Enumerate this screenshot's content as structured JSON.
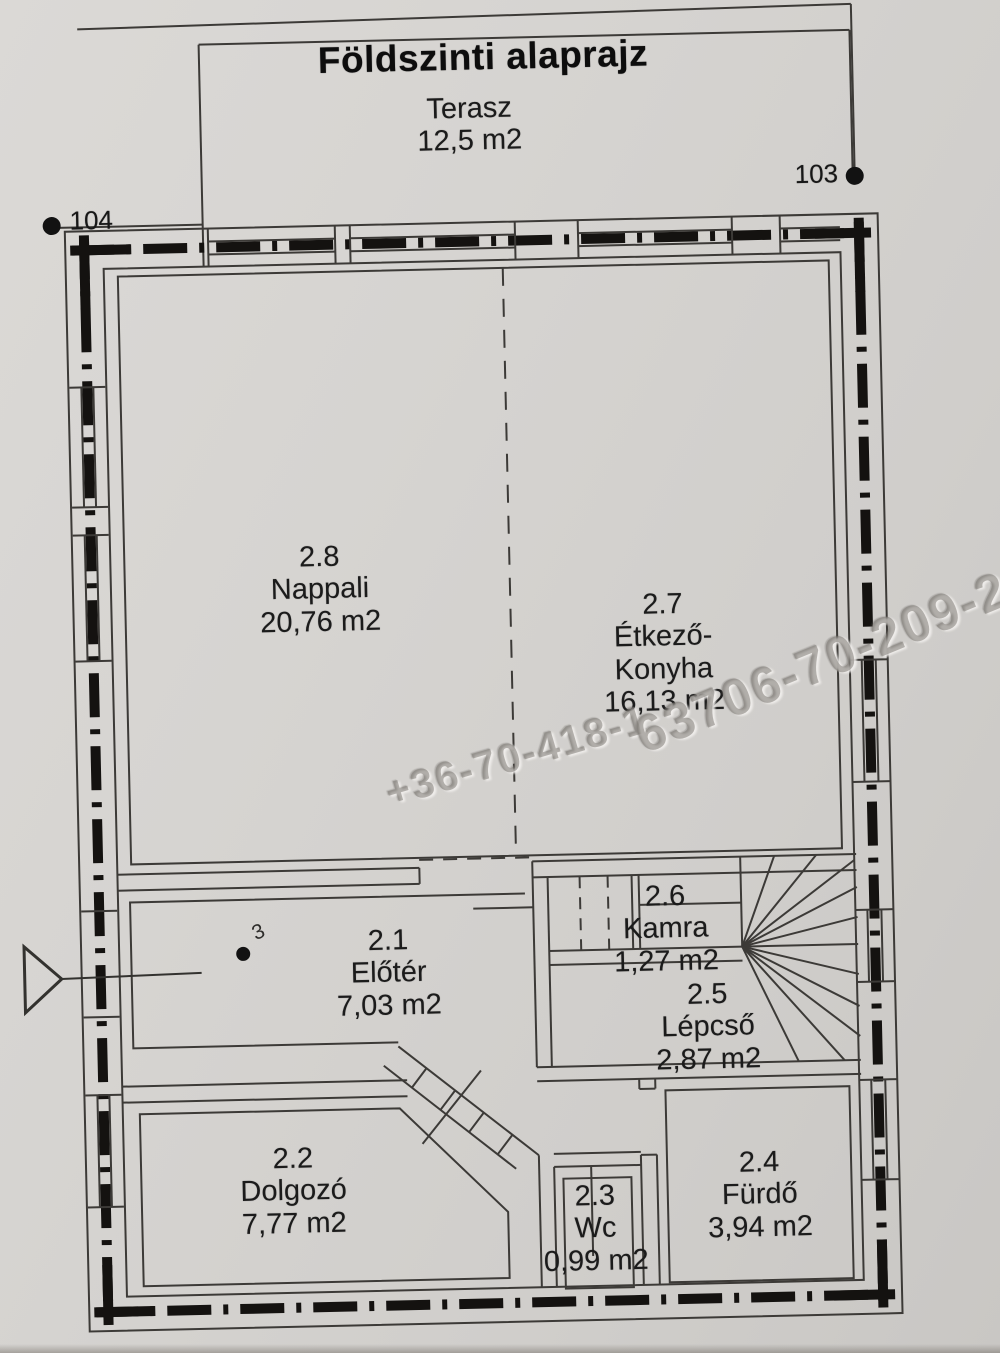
{
  "title": "Földszinti alaprajz",
  "terrace": {
    "name": "Terasz",
    "area": "12,5 m2"
  },
  "survey_markers": {
    "right": "103",
    "left": "104"
  },
  "rooms": {
    "nappali": {
      "id": "2.8",
      "name": "Nappali",
      "area": "20,76 m2"
    },
    "etkezo": {
      "id": "2.7",
      "name_line1": "Étkező-",
      "name_line2": "Konyha",
      "area": "16,13 m2"
    },
    "kamra": {
      "id": "2.6",
      "name": "Kamra",
      "area": "1,27 m2"
    },
    "lepcso": {
      "id": "2.5",
      "name": "Lépcső",
      "area": "2,87 m2"
    },
    "eloter": {
      "id": "2.1",
      "name": "Előtér",
      "area": "7,03 m2"
    },
    "dolgozo": {
      "id": "2.2",
      "name": "Dolgozó",
      "area": "7,77 m2"
    },
    "wc": {
      "id": "2.3",
      "name": "Wc",
      "area": "0,99 m2"
    },
    "furdo": {
      "id": "2.4",
      "name": "Fürdő",
      "area": "3,94 m2"
    }
  },
  "watermark": {
    "part1": "+36-70-418-1",
    "part2": "63706-70-209-2"
  },
  "handwritten_note": "3",
  "colors": {
    "paper": "#d6d3d0",
    "line": "#3c3a37",
    "wall_fill": "#141210",
    "text": "#1b1b1b",
    "watermark": "#8e8b86"
  }
}
